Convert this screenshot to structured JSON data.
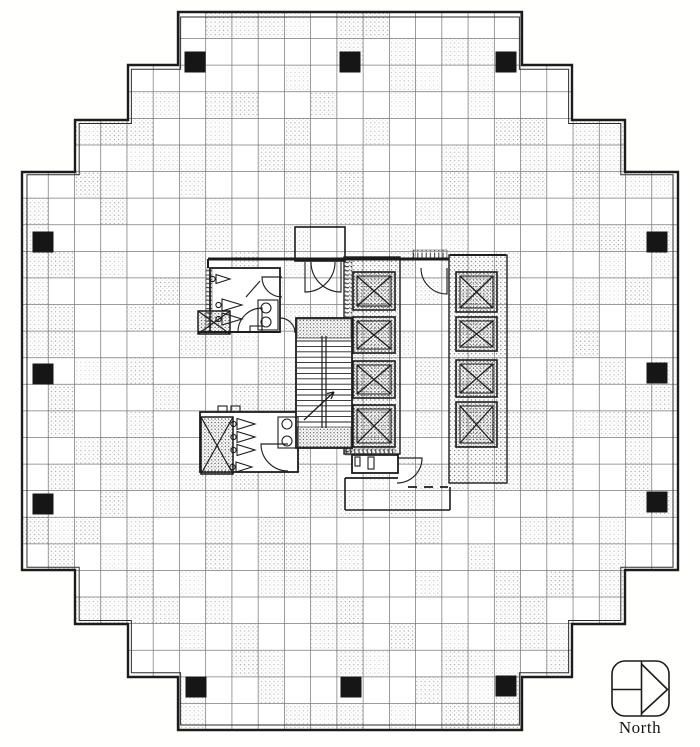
{
  "north_indicator": {
    "label": "North"
  },
  "plan": {
    "canvas": {
      "width": 700,
      "height": 747
    },
    "colors": {
      "paper": "#ffffff",
      "ink": "#1c1c1c",
      "grid": "#4f4f4f",
      "column_fill": "#161616",
      "stipple": "#777777"
    },
    "outline": [
      [
        178,
        12
      ],
      [
        522,
        12
      ],
      [
        522,
        65
      ],
      [
        572,
        65
      ],
      [
        572,
        120
      ],
      [
        625,
        120
      ],
      [
        625,
        172
      ],
      [
        678,
        172
      ],
      [
        678,
        570
      ],
      [
        625,
        570
      ],
      [
        625,
        624
      ],
      [
        572,
        624
      ],
      [
        572,
        677
      ],
      [
        522,
        677
      ],
      [
        522,
        730
      ],
      [
        178,
        730
      ],
      [
        178,
        677
      ],
      [
        128,
        677
      ],
      [
        128,
        624
      ],
      [
        75,
        624
      ],
      [
        75,
        570
      ],
      [
        22,
        570
      ],
      [
        22,
        172
      ],
      [
        75,
        172
      ],
      [
        75,
        120
      ],
      [
        128,
        120
      ],
      [
        128,
        65
      ],
      [
        178,
        65
      ]
    ],
    "grid": {
      "x0": 22,
      "y0": 12,
      "x1": 678,
      "y1": 730,
      "cols": 25,
      "rows": 27,
      "shade_fraction": 0.45
    },
    "columns": {
      "size": 21,
      "centers": [
        [
          195,
          62
        ],
        [
          350,
          62
        ],
        [
          506,
          62
        ],
        [
          43,
          242
        ],
        [
          43,
          374
        ],
        [
          43,
          504
        ],
        [
          657,
          242
        ],
        [
          657,
          373
        ],
        [
          657,
          502
        ],
        [
          196,
          687
        ],
        [
          351,
          687
        ],
        [
          506,
          686
        ]
      ]
    },
    "core": {
      "walls": [
        [
          208,
          259,
          449,
          259,
          3
        ],
        [
          198,
          332,
          280,
          332,
          2
        ],
        [
          208,
          259,
          208,
          268,
          2
        ],
        [
          450,
          255,
          506,
          255,
          2
        ],
        [
          345,
          478,
          398,
          478,
          1.8
        ],
        [
          345,
          478,
          345,
          510,
          1.6
        ],
        [
          345,
          510,
          450,
          510,
          1.6
        ],
        [
          450,
          487,
          450,
          510,
          1.6
        ]
      ],
      "dashed_walls": [
        [
          408,
          487,
          448,
          487
        ]
      ],
      "misc_lines": [
        [
          246,
          297,
          260,
          281
        ]
      ],
      "notch": [
        295,
        227,
        50,
        34
      ],
      "rooms": [
        {
          "name": "restroom-north",
          "rect": [
            210,
            268,
            70,
            64
          ]
        },
        {
          "name": "restroom-south",
          "rect": [
            200,
            412,
            98,
            60
          ]
        },
        {
          "name": "service-room",
          "rect": [
            352,
            455,
            46,
            18
          ]
        }
      ],
      "shafts": [
        {
          "name": "elevator-bank-west",
          "rect": [
            344,
            257,
            56,
            197
          ],
          "cars": [
            [
              353,
              272,
              42,
              38
            ],
            [
              353,
              317,
              42,
              36
            ],
            [
              353,
              361,
              42,
              37
            ],
            [
              353,
              405,
              42,
              42
            ]
          ]
        },
        {
          "name": "elevator-bank-east",
          "rect": [
            449,
            255,
            58,
            228
          ],
          "cars": [
            [
              456,
              272,
              41,
              40
            ],
            [
              456,
              317,
              41,
              34
            ],
            [
              456,
              360,
              41,
              37
            ],
            [
              456,
              402,
              41,
              45
            ]
          ]
        }
      ],
      "xboxes": [
        [
          198,
          311,
          32,
          23
        ],
        [
          201,
          417,
          32,
          57
        ]
      ],
      "combs": [
        [
          344,
          258,
          8,
          194,
          "h"
        ],
        [
          345,
          449,
          50,
          6,
          "v"
        ],
        [
          206,
          269,
          6,
          56,
          "h"
        ],
        [
          413,
          250,
          34,
          8,
          "v"
        ]
      ],
      "stair": {
        "rect": [
          296,
          318,
          56,
          130
        ],
        "landings": [
          [
            297,
            319,
            54,
            19
          ],
          [
            297,
            427,
            54,
            20
          ]
        ],
        "tread_y0": 341,
        "tread_y1": 426,
        "tread_step": 5.4,
        "dividers": [
          322,
          326
        ],
        "arrow": [
          304,
          420,
          334,
          392
        ]
      },
      "fixtures": {
        "triangles": [
          [
            230,
            279,
            14,
            9
          ],
          [
            242,
            305,
            20,
            12
          ],
          [
            242,
            319,
            20,
            12
          ],
          [
            255,
            424,
            18,
            11
          ],
          [
            255,
            437,
            18,
            11
          ],
          [
            255,
            450,
            18,
            11
          ],
          [
            252,
            467,
            16,
            10
          ]
        ],
        "circles": [
          [
            266,
            308,
            5
          ],
          [
            266,
            322,
            5
          ],
          [
            287,
            424,
            5
          ],
          [
            287,
            441,
            5
          ]
        ],
        "rects": [
          [
            258,
            300,
            20,
            30
          ],
          [
            278,
            417,
            20,
            31
          ],
          [
            218,
            406,
            9,
            6
          ],
          [
            231,
            406,
            9,
            6
          ],
          [
            250,
            326,
            12,
            6
          ],
          [
            355,
            457,
            5,
            9
          ],
          [
            368,
            457,
            6,
            12
          ]
        ]
      },
      "door_arcs": [
        [
          305,
          262,
          30,
          90,
          0
        ],
        [
          341,
          262,
          30,
          90,
          180
        ],
        [
          262,
          332,
          24,
          270,
          180
        ],
        [
          288,
          444,
          27,
          180,
          90
        ],
        [
          397,
          458,
          25,
          0,
          90
        ],
        [
          447,
          268,
          26,
          90,
          180
        ],
        [
          282,
          277,
          20,
          180,
          90
        ],
        [
          280,
          333,
          15,
          270,
          0
        ]
      ]
    },
    "north_box": [
      612,
      661,
      57,
      55,
      13
    ]
  }
}
